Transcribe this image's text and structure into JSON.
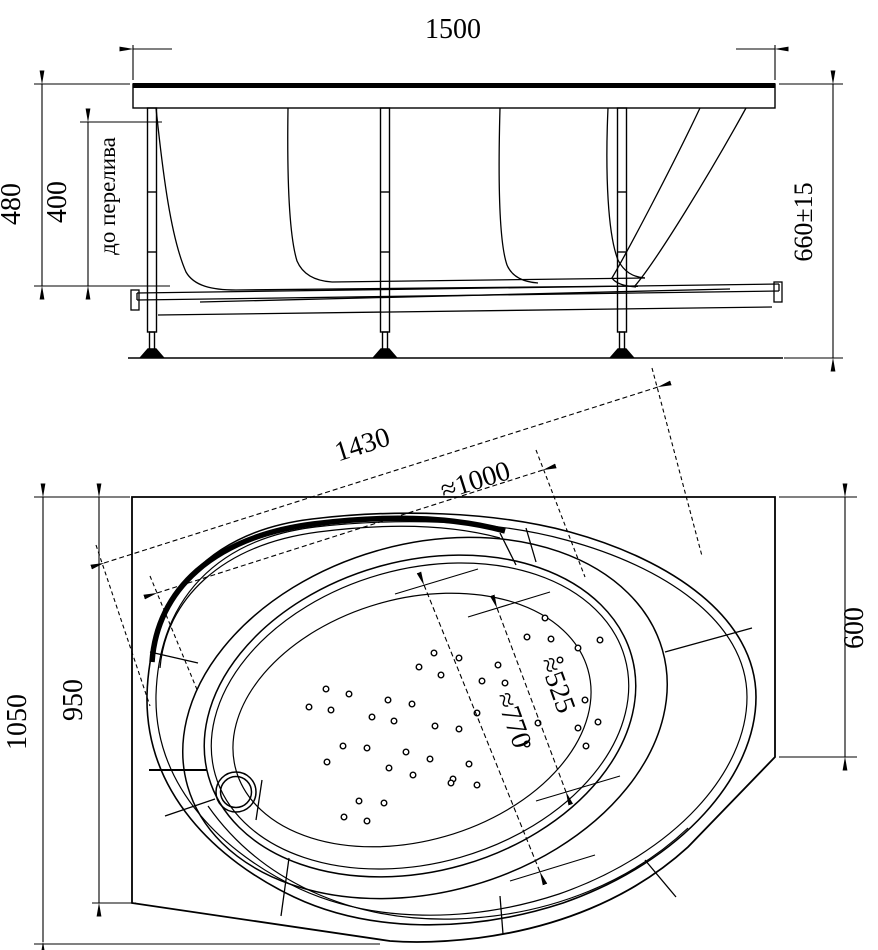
{
  "meta": {
    "type": "technical drawing",
    "subject": "corner bathtub with support frame, two projection views",
    "line_color": "#000000",
    "bg_color": "#ffffff"
  },
  "side_view": {
    "name": "front elevation with frame",
    "dimensions": {
      "width_top": "1500",
      "height_rim": "480",
      "height_overflow": "400",
      "overflow_note": "до перелива",
      "height_overall": "660±15"
    }
  },
  "plan_view": {
    "name": "top plan view",
    "dimensions": {
      "diag_total": "1430",
      "diag_rim": "≈1000",
      "depth_total": "1050",
      "depth_corner": "950",
      "side_right": "600",
      "basin_width": "≈525",
      "basin_length": "≈770"
    },
    "drain": {
      "cx": 236,
      "cy": 792,
      "r_outer": 20,
      "r_inner": 15.5
    },
    "jets": [
      [
        545,
        618
      ],
      [
        527,
        637
      ],
      [
        551,
        639
      ],
      [
        578,
        648
      ],
      [
        560,
        660
      ],
      [
        600,
        640
      ],
      [
        434,
        653
      ],
      [
        459,
        658
      ],
      [
        419,
        667
      ],
      [
        441,
        675
      ],
      [
        498,
        665
      ],
      [
        505,
        683
      ],
      [
        482,
        681
      ],
      [
        388,
        700
      ],
      [
        412,
        704
      ],
      [
        394,
        721
      ],
      [
        435,
        726
      ],
      [
        459,
        729
      ],
      [
        477,
        713
      ],
      [
        538,
        723
      ],
      [
        406,
        752
      ],
      [
        430,
        759
      ],
      [
        389,
        768
      ],
      [
        413,
        775
      ],
      [
        453,
        779
      ],
      [
        469,
        764
      ],
      [
        527,
        744
      ],
      [
        578,
        728
      ],
      [
        586,
        746
      ],
      [
        585,
        700
      ],
      [
        598,
        722
      ],
      [
        384,
        803
      ],
      [
        451,
        783
      ],
      [
        477,
        785
      ],
      [
        326,
        689
      ],
      [
        349,
        694
      ],
      [
        309,
        707
      ],
      [
        331,
        710
      ],
      [
        372,
        717
      ],
      [
        343,
        746
      ],
      [
        367,
        748
      ],
      [
        327,
        762
      ],
      [
        359,
        801
      ],
      [
        344,
        817
      ],
      [
        367,
        821
      ]
    ]
  }
}
